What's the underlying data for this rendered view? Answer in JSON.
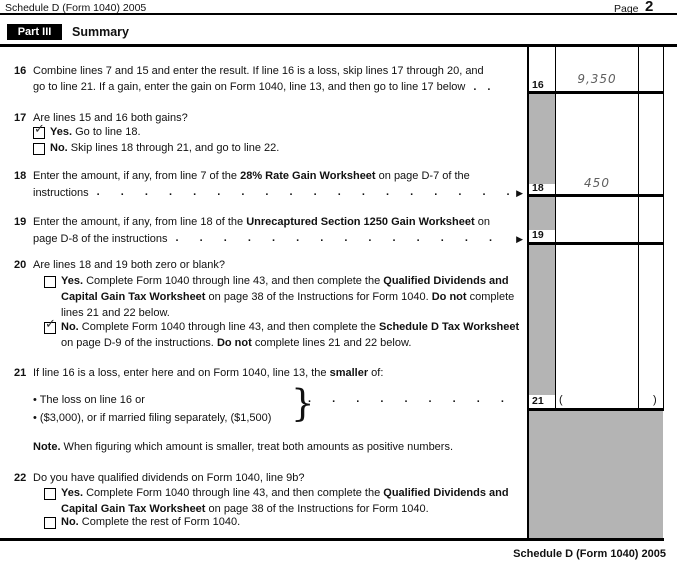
{
  "page": {
    "header_left": "Schedule D (Form 1040) 2005",
    "page_label": "Page",
    "page_number": "2",
    "part_label": "Part III",
    "part_title": "Summary",
    "footer": "Schedule D (Form 1040) 2005"
  },
  "icons": {
    "check": "✓",
    "arrow": "▶",
    "brace": "}"
  },
  "leaders": {
    "dots_long": ". . . . . . . . . . . . . . . . . . . . . . . . . . . . . . . . . . . . . . . .",
    "dots_short": ".."
  },
  "values": {
    "line16": "9,350",
    "line18": "450",
    "line19": "",
    "line21_open": "(",
    "line21_close": ")"
  },
  "rows": {
    "r16": {
      "num": "16",
      "box_num": "16",
      "l1": [
        {
          "t": "Combine lines 7 and 15 and enter the result. If line 16 is a loss, skip lines 17 through 20, and"
        }
      ],
      "l2": [
        {
          "t": "go to line 21. If a gain, enter the gain on Form 1040, line 13, and then go to line 17 below"
        }
      ]
    },
    "r17": {
      "num": "17",
      "q": [
        {
          "t": "Are lines 15 and 16 both gains?"
        }
      ],
      "yes": [
        {
          "t": "Yes.",
          "b": 1
        },
        {
          "t": " Go to line 18."
        }
      ],
      "yes_checked": true,
      "no": [
        {
          "t": "No.",
          "b": 1
        },
        {
          "t": " Skip lines 18 through 21, and go to line 22."
        }
      ],
      "no_checked": false
    },
    "r18": {
      "num": "18",
      "box_num": "18",
      "l1": [
        {
          "t": "Enter the amount, if any, from line 7 of the "
        },
        {
          "t": "28% Rate Gain Worksheet",
          "b": 1
        },
        {
          "t": " on page D-7 of the"
        }
      ],
      "l2": [
        {
          "t": "instructions"
        }
      ]
    },
    "r19": {
      "num": "19",
      "box_num": "19",
      "l1": [
        {
          "t": "Enter the amount, if any, from line 18 of the "
        },
        {
          "t": "Unrecaptured Section 1250 Gain Worksheet",
          "b": 1
        },
        {
          "t": " on"
        }
      ],
      "l2": [
        {
          "t": "page D-8 of the instructions"
        }
      ]
    },
    "r20": {
      "num": "20",
      "q": [
        {
          "t": "Are lines 18 and 19 both zero or blank?"
        }
      ],
      "yes1": [
        {
          "t": "Yes.",
          "b": 1
        },
        {
          "t": " Complete Form 1040 through line 43, and then complete the "
        },
        {
          "t": "Qualified Dividends and",
          "b": 1
        }
      ],
      "yes2": [
        {
          "t": "Capital Gain Tax Worksheet",
          "b": 1
        },
        {
          "t": " on page 38 of the Instructions for Form 1040. "
        },
        {
          "t": "Do not",
          "b": 1
        },
        {
          "t": " complete"
        }
      ],
      "yes3": [
        {
          "t": "lines 21 and 22 below."
        }
      ],
      "yes_checked": false,
      "no1": [
        {
          "t": "No.",
          "b": 1
        },
        {
          "t": " Complete Form 1040 through line 43, and then complete the "
        },
        {
          "t": "Schedule D Tax Worksheet",
          "b": 1
        }
      ],
      "no2": [
        {
          "t": "on page D-9 of the instructions. "
        },
        {
          "t": "Do not",
          "b": 1
        },
        {
          "t": " complete lines 21 and 22 below."
        }
      ],
      "no_checked": true
    },
    "r21": {
      "num": "21",
      "box_num": "21",
      "q": [
        {
          "t": "If line 16 is a loss, enter here and on Form 1040, line 13, the "
        },
        {
          "t": "smaller",
          "b": 1
        },
        {
          "t": " of:"
        }
      ],
      "b1": [
        {
          "t": "• The loss on line 16 or"
        }
      ],
      "b2": [
        {
          "t": "• ($3,000), or if married filing separately, ($1,500)"
        }
      ],
      "note": [
        {
          "t": "Note.",
          "b": 1
        },
        {
          "t": " When figuring which amount is smaller, treat both amounts as positive numbers."
        }
      ]
    },
    "r22": {
      "num": "22",
      "q": [
        {
          "t": "Do you have qualified dividends on Form 1040, line 9b?"
        }
      ],
      "yes1": [
        {
          "t": "Yes.",
          "b": 1
        },
        {
          "t": " Complete Form 1040 through line 43, and then complete the "
        },
        {
          "t": "Qualified Dividends and",
          "b": 1
        }
      ],
      "yes2": [
        {
          "t": "Capital Gain Tax Worksheet",
          "b": 1
        },
        {
          "t": " on page 38 of the Instructions for Form 1040."
        }
      ],
      "yes_checked": false,
      "no": [
        {
          "t": "No.",
          "b": 1
        },
        {
          "t": " Complete the rest of Form 1040."
        }
      ],
      "no_checked": false
    }
  },
  "colors": {
    "shade": "#b4b4b4",
    "ink": "#111111",
    "value_ink": "#5f5f5f"
  }
}
